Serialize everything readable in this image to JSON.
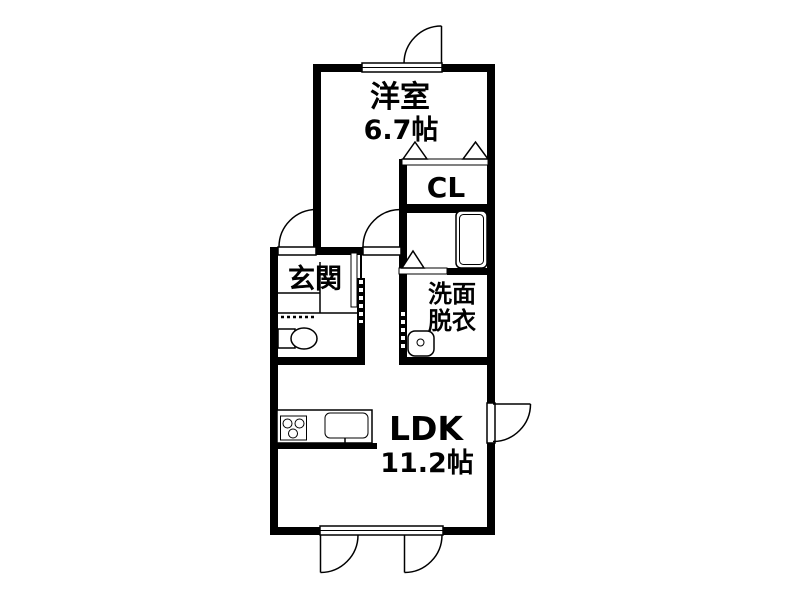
{
  "diagram": {
    "type": "floor-plan",
    "background_color": "#ffffff",
    "line_color": "#000000",
    "rooms": {
      "western_room": {
        "name": "洋室",
        "size": "6.7帖"
      },
      "closet": {
        "name": "CL"
      },
      "entrance": {
        "name": "玄関"
      },
      "washroom": {
        "name_line_1": "洗面",
        "name_line_2": "脱衣"
      },
      "ldk": {
        "name": "LDK",
        "size": "11.2帖"
      }
    },
    "fixtures": [
      "bathtub",
      "toilet",
      "washbasin",
      "kitchen-stove",
      "kitchen-sink"
    ],
    "door_symbols": [
      "swing-door",
      "folding-door",
      "sliding-door",
      "double-terrace-door"
    ]
  }
}
